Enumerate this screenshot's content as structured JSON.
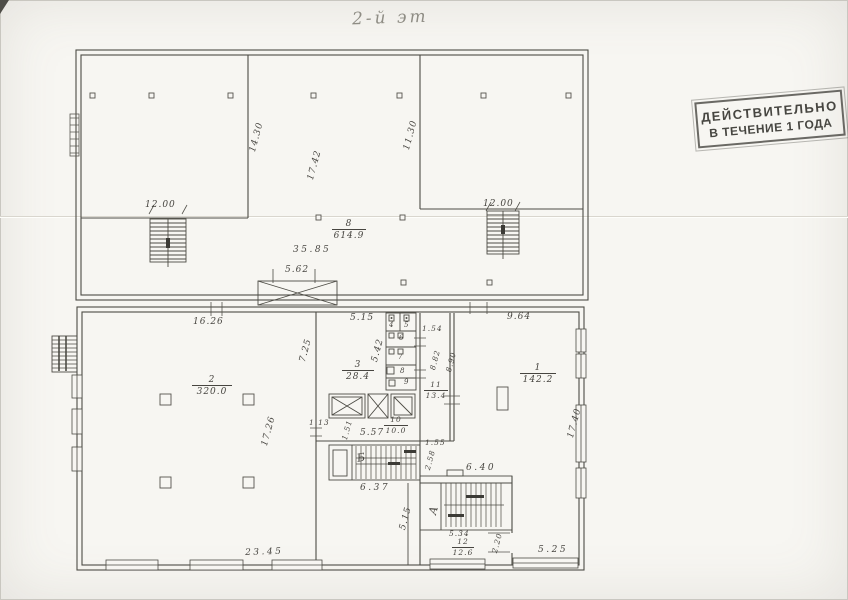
{
  "page": {
    "title": "2-й эт"
  },
  "stamp": {
    "line1": "ДЕЙСТВИТЕЛЬНО",
    "line2": "В ТЕЧЕНИЕ 1 ГОДА"
  },
  "dims": {
    "d12l": "12.00",
    "d12r": "12.00",
    "d1430": "14.30",
    "d1742": "17.42",
    "d1130": "11.30",
    "d3585": "35.85",
    "d562": "5.62",
    "d1626": "16.26",
    "d515t": "5.15",
    "d964": "9.64",
    "d725": "7.25",
    "d542": "5.42",
    "d154": "1.54",
    "d882": "8.82",
    "d890": "8.90",
    "d1740": "17.40",
    "d1726": "17.26",
    "d113": "1.13",
    "d151": "1.51",
    "d557": "5.57",
    "d637": "6.37",
    "d155": "1.55",
    "d258": "2.58",
    "d640": "6.40",
    "d515l": "5.15",
    "d534": "5.34",
    "d220": "2.20",
    "d525": "5.25",
    "d2345": "23.45"
  },
  "rooms": {
    "r8": {
      "num": "8",
      "area": "614.9"
    },
    "r2": {
      "num": "2",
      "area": "320.0"
    },
    "r3": {
      "num": "3",
      "area": "28.4"
    },
    "r1": {
      "num": "1",
      "area": "142.2"
    },
    "r10": {
      "num": "10",
      "area": "10.0"
    },
    "r11": {
      "num": "11",
      "area": "13.4"
    },
    "r12": {
      "num": "12",
      "area": "12.6"
    }
  },
  "cabins": {
    "c4": "4",
    "c5": "5",
    "c6": "6",
    "c7": "7",
    "c8": "8",
    "c9": "9"
  },
  "stairs": {
    "a": "А",
    "b": "Б"
  },
  "colors": {
    "ink": "#4d4c45",
    "paper": "#f7f6f2",
    "stamp_ink": "#474641"
  }
}
